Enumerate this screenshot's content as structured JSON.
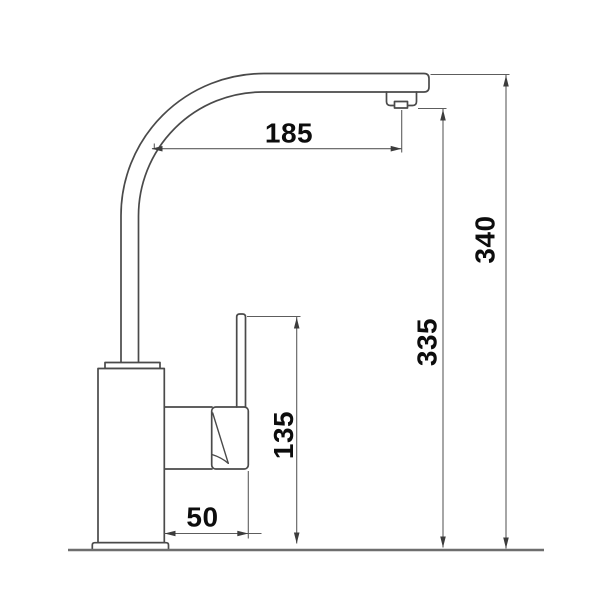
{
  "drawing": {
    "kind": "faucet-dimension-diagram",
    "dimensions": {
      "spout_reach": {
        "value": "185"
      },
      "overall_height": {
        "value": "340"
      },
      "outlet_height": {
        "value": "335"
      },
      "handle_height": {
        "value": "135"
      },
      "handle_projection": {
        "value": "50"
      }
    }
  },
  "colors": {
    "background": "#ffffff",
    "line": "#4a4a4a",
    "dim_line": "#5d5d5d",
    "baseline": "#6e6e6e",
    "arrow": "#3c3c3c",
    "text": "#0d0d0d"
  }
}
